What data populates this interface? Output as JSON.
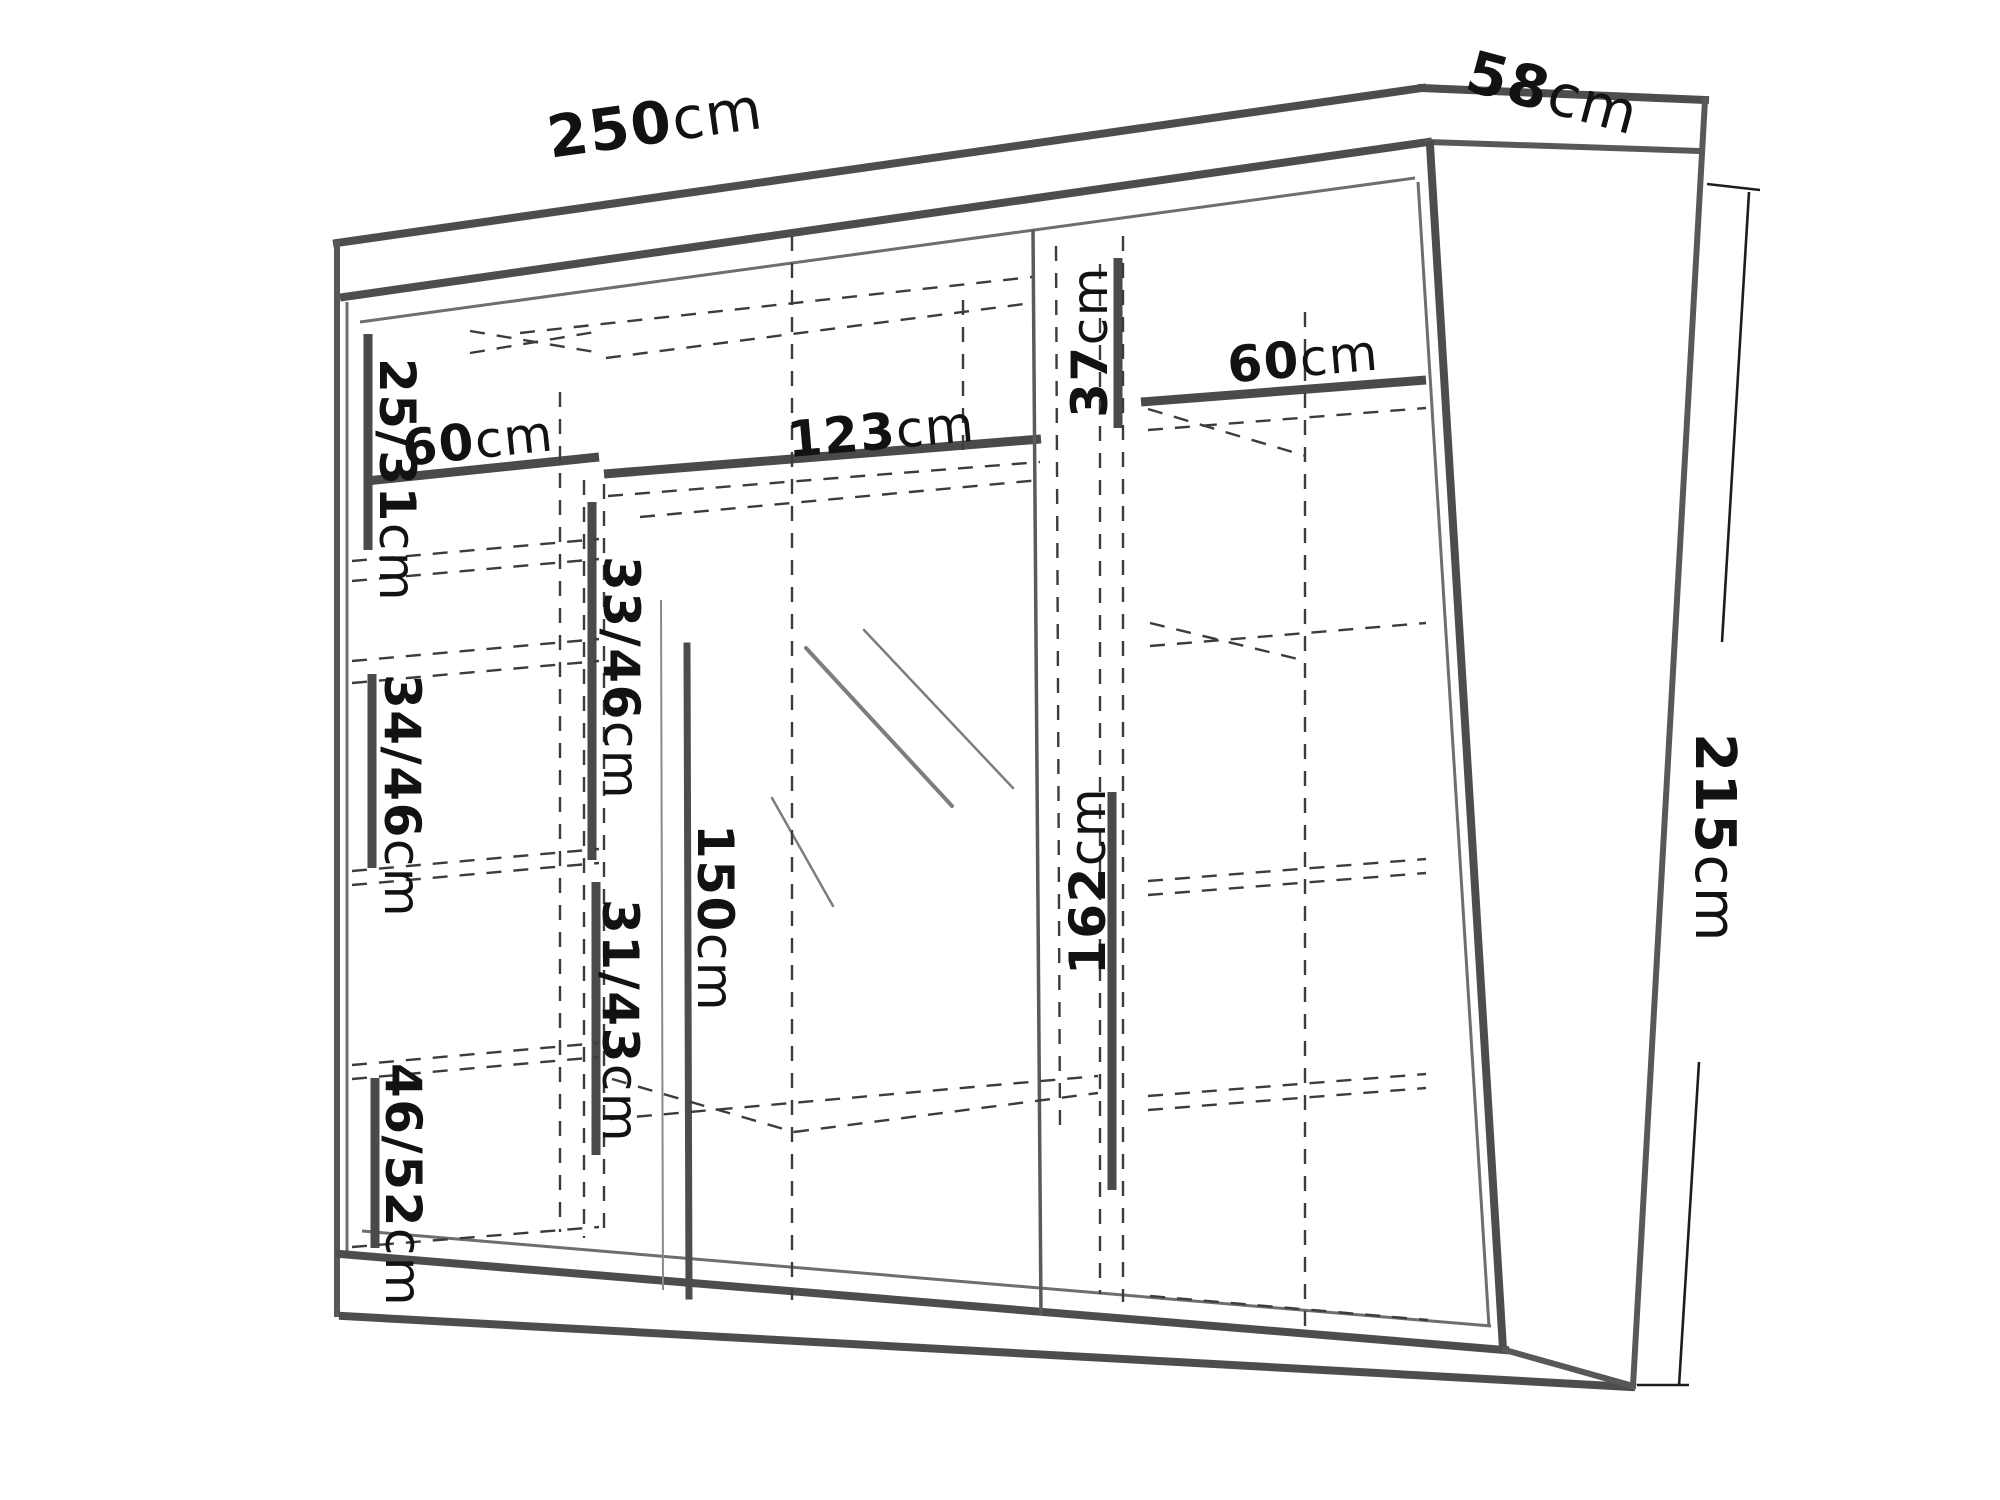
{
  "meta": {
    "background_color": "#ffffff",
    "line_color": "#4d4d4d",
    "dashed_line_color": "#3c3c3c",
    "text_color": "#121212"
  },
  "overall_dimensions": {
    "width": {
      "value": "250",
      "unit": "cm"
    },
    "depth": {
      "value": "58",
      "unit": "cm"
    },
    "height": {
      "value": "215",
      "unit": "cm"
    }
  },
  "internal_dimensions": [
    "25/31cm",
    "60cm",
    "123cm",
    "37cm",
    "60cm",
    "33/46cm",
    "34/46cm",
    "31/43cm",
    "46/52cm",
    "150cm",
    "162cm"
  ],
  "labels": [
    {
      "id": "width-250",
      "value": "250",
      "unit": "cm",
      "x": 655,
      "y": 122,
      "rotate": -8,
      "size": 58
    },
    {
      "id": "depth-58",
      "value": "58",
      "unit": "cm",
      "x": 1553,
      "y": 92,
      "rotate": 15,
      "size": 58
    },
    {
      "id": "height-215",
      "value": "215",
      "unit": "cm",
      "x": 1716,
      "y": 838,
      "rotate": 90,
      "size": 56
    },
    {
      "id": "shelf-60-left",
      "value": "60",
      "unit": "cm",
      "x": 478,
      "y": 440,
      "rotate": -6,
      "size": 50
    },
    {
      "id": "compartment-25-31",
      "value": "25/31",
      "unit": "cm",
      "x": 398,
      "y": 480,
      "rotate": 90,
      "size": 50
    },
    {
      "id": "compartment-33-46",
      "value": "33/46",
      "unit": "cm",
      "x": 622,
      "y": 678,
      "rotate": 90,
      "size": 50
    },
    {
      "id": "shelf-123",
      "value": "123",
      "unit": "cm",
      "x": 881,
      "y": 431,
      "rotate": -5,
      "size": 50
    },
    {
      "id": "compartment-37",
      "value": "37",
      "unit": "cm",
      "x": 1089,
      "y": 342,
      "rotate": -90,
      "size": 50
    },
    {
      "id": "shelf-60-right",
      "value": "60",
      "unit": "cm",
      "x": 1303,
      "y": 358,
      "rotate": -5,
      "size": 50
    },
    {
      "id": "compartment-34-46",
      "value": "34/46",
      "unit": "cm",
      "x": 403,
      "y": 796,
      "rotate": 90,
      "size": 50
    },
    {
      "id": "compartment-31-43",
      "value": "31/43",
      "unit": "cm",
      "x": 621,
      "y": 1021,
      "rotate": 90,
      "size": 50
    },
    {
      "id": "compartment-46-52",
      "value": "46/52",
      "unit": "cm",
      "x": 404,
      "y": 1185,
      "rotate": 90,
      "size": 50
    },
    {
      "id": "mirror-150",
      "value": "150",
      "unit": "cm",
      "x": 716,
      "y": 918,
      "rotate": 90,
      "size": 50
    },
    {
      "id": "compartment-162",
      "value": "162",
      "unit": "cm",
      "x": 1087,
      "y": 881,
      "rotate": -90,
      "size": 50
    }
  ]
}
